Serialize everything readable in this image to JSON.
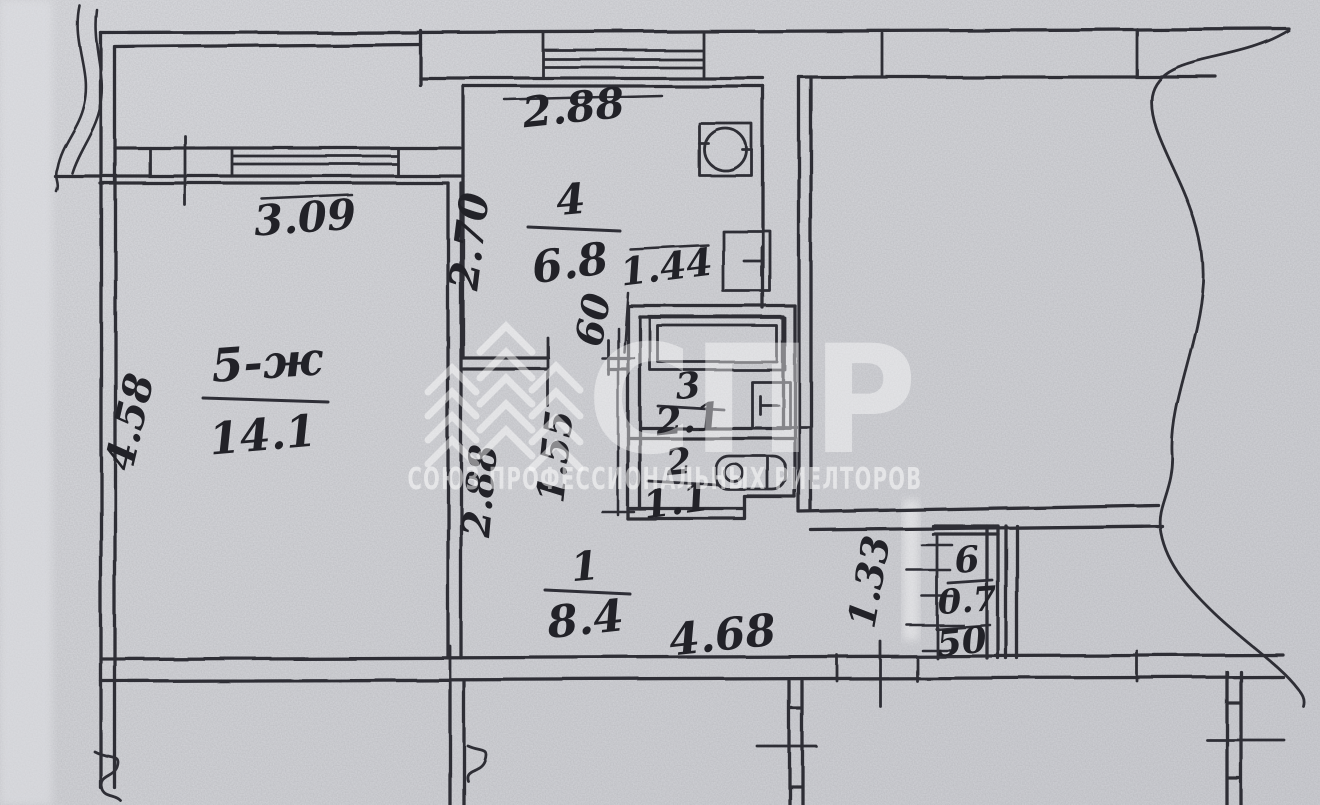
{
  "document": {
    "kind": "scanned-floor-plan",
    "description": "Hand-drawn BTI apartment floor plan on grey paper with realtor watermark"
  },
  "colors": {
    "paper": "#d6d7db",
    "ink": "#2e2e36",
    "watermark": "#ffffff"
  },
  "watermark": {
    "letters": "СПР",
    "text": "СОЮЗ ПРОФЕССИОНАЛЬНЫХ РИЕЛТОРОВ"
  },
  "rooms": [
    {
      "number": "5-ж",
      "area": "14.1",
      "note": "living room"
    },
    {
      "number": "4",
      "area": "6.8",
      "note": "kitchen"
    },
    {
      "number": "3",
      "area": "2.1",
      "note": "bathroom"
    },
    {
      "number": "2",
      "area": "1.1",
      "note": "toilet"
    },
    {
      "number": "1",
      "area": "8.4",
      "note": "hallway"
    },
    {
      "number": "6",
      "area": "0.7",
      "note": "closet"
    }
  ],
  "dimensions": {
    "room5_window": "3.09",
    "room5_height": "4.58",
    "kitchen_window": "2.88",
    "kitchen_height": "2.70",
    "kitchen_inner": "1.44",
    "door_width": "60",
    "bath_height": "1.55",
    "hall_left_height": "2.88",
    "hall_width": "4.68",
    "closet_height": "1.33",
    "closet_width": "50"
  }
}
